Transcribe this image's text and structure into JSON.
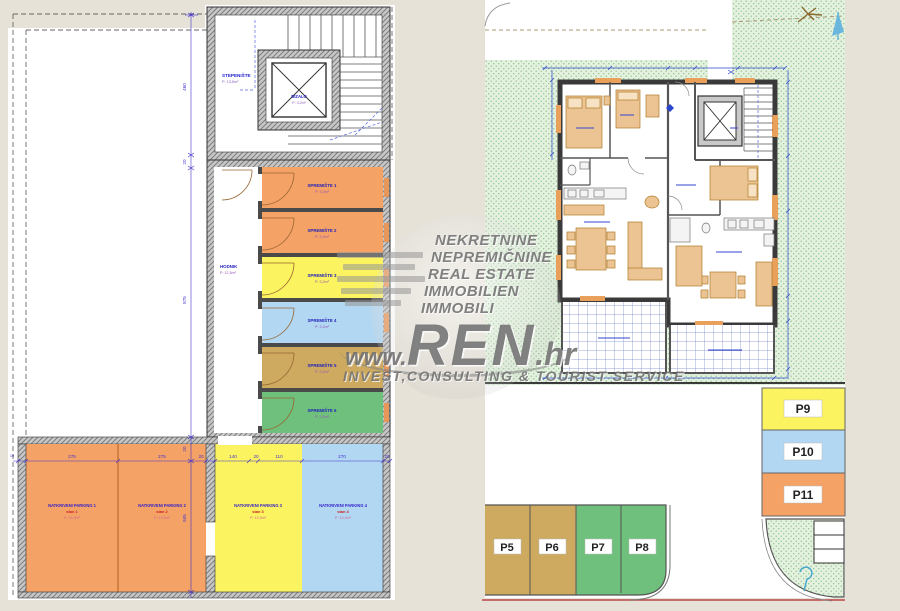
{
  "watermark": {
    "lines": [
      "NEKRETNINE",
      "NEPREMIČNINE",
      "REAL ESTATE",
      "IMMOBILIEN",
      "IMMOBILI"
    ],
    "brand_prefix": "www.",
    "brand": "REN",
    "brand_suffix": ".hr",
    "tagline": "INVEST,CONSULTING & TOURIST SERVICE"
  },
  "left_plan": {
    "staircase": {
      "name": "STEPENIŠTE",
      "area": "P: 13,5m²"
    },
    "elevator": {
      "name": "DIZALO",
      "area": "P: 3,2m²"
    },
    "hallway": {
      "name": "HODNIK",
      "area": "P: 12,5m²"
    },
    "storage_rooms": [
      {
        "name": "SPREMIŠTE 1",
        "area": "P: 3,2m²",
        "color": "#F4A265"
      },
      {
        "name": "SPREMIŠTE 2",
        "area": "P: 3,2m²",
        "color": "#F4A265"
      },
      {
        "name": "SPREMIŠTE 3",
        "area": "P: 3,2m²",
        "color": "#FBF35F"
      },
      {
        "name": "SPREMIŠTE 4",
        "area": "P: 3,2m²",
        "color": "#B2D7F2"
      },
      {
        "name": "SPREMIŠTE 5",
        "area": "P: 3,2m²",
        "color": "#CDAA60"
      },
      {
        "name": "SPREMIŠTE 6",
        "area": "P: 3,2m²",
        "color": "#6FC07C"
      }
    ],
    "parking_spaces": [
      {
        "name": "NATKRIVENI PARKING 1",
        "unit": "stan 1",
        "area": "P: 13,3m²",
        "color": "#F4A265"
      },
      {
        "name": "NATKRIVENI PARKING 2",
        "unit": "stan 2",
        "area": "P: 13,3m²",
        "color": "#F4A265"
      },
      {
        "name": "NATKRIVENI PARKING 3",
        "unit": "stan 3",
        "area": "P: 13,3m²",
        "color": "#FBF35F"
      },
      {
        "name": "NATKRIVENI PARKING 4",
        "unit": "stan 4",
        "area": "P: 13,3m²",
        "color": "#B2D7F2"
      }
    ],
    "dims_h": [
      "275",
      "275",
      "20",
      "140",
      "20",
      "110",
      "270",
      "25"
    ],
    "dims_v": [
      "460",
      "20",
      "875",
      "20",
      "505"
    ],
    "dim_left": "10"
  },
  "right_plan": {
    "parking_column": [
      {
        "label": "P9",
        "color": "#FBF35F"
      },
      {
        "label": "P10",
        "color": "#B2D7F2"
      },
      {
        "label": "P11",
        "color": "#F4A265"
      }
    ],
    "parking_row": [
      {
        "label": "P5",
        "color": "#CDAA60"
      },
      {
        "label": "P6",
        "color": "#CDAA60"
      },
      {
        "label": "P7",
        "color": "#6FC07C"
      },
      {
        "label": "P8",
        "color": "#6FC07C"
      }
    ],
    "site_color": "#E4F1DE"
  }
}
